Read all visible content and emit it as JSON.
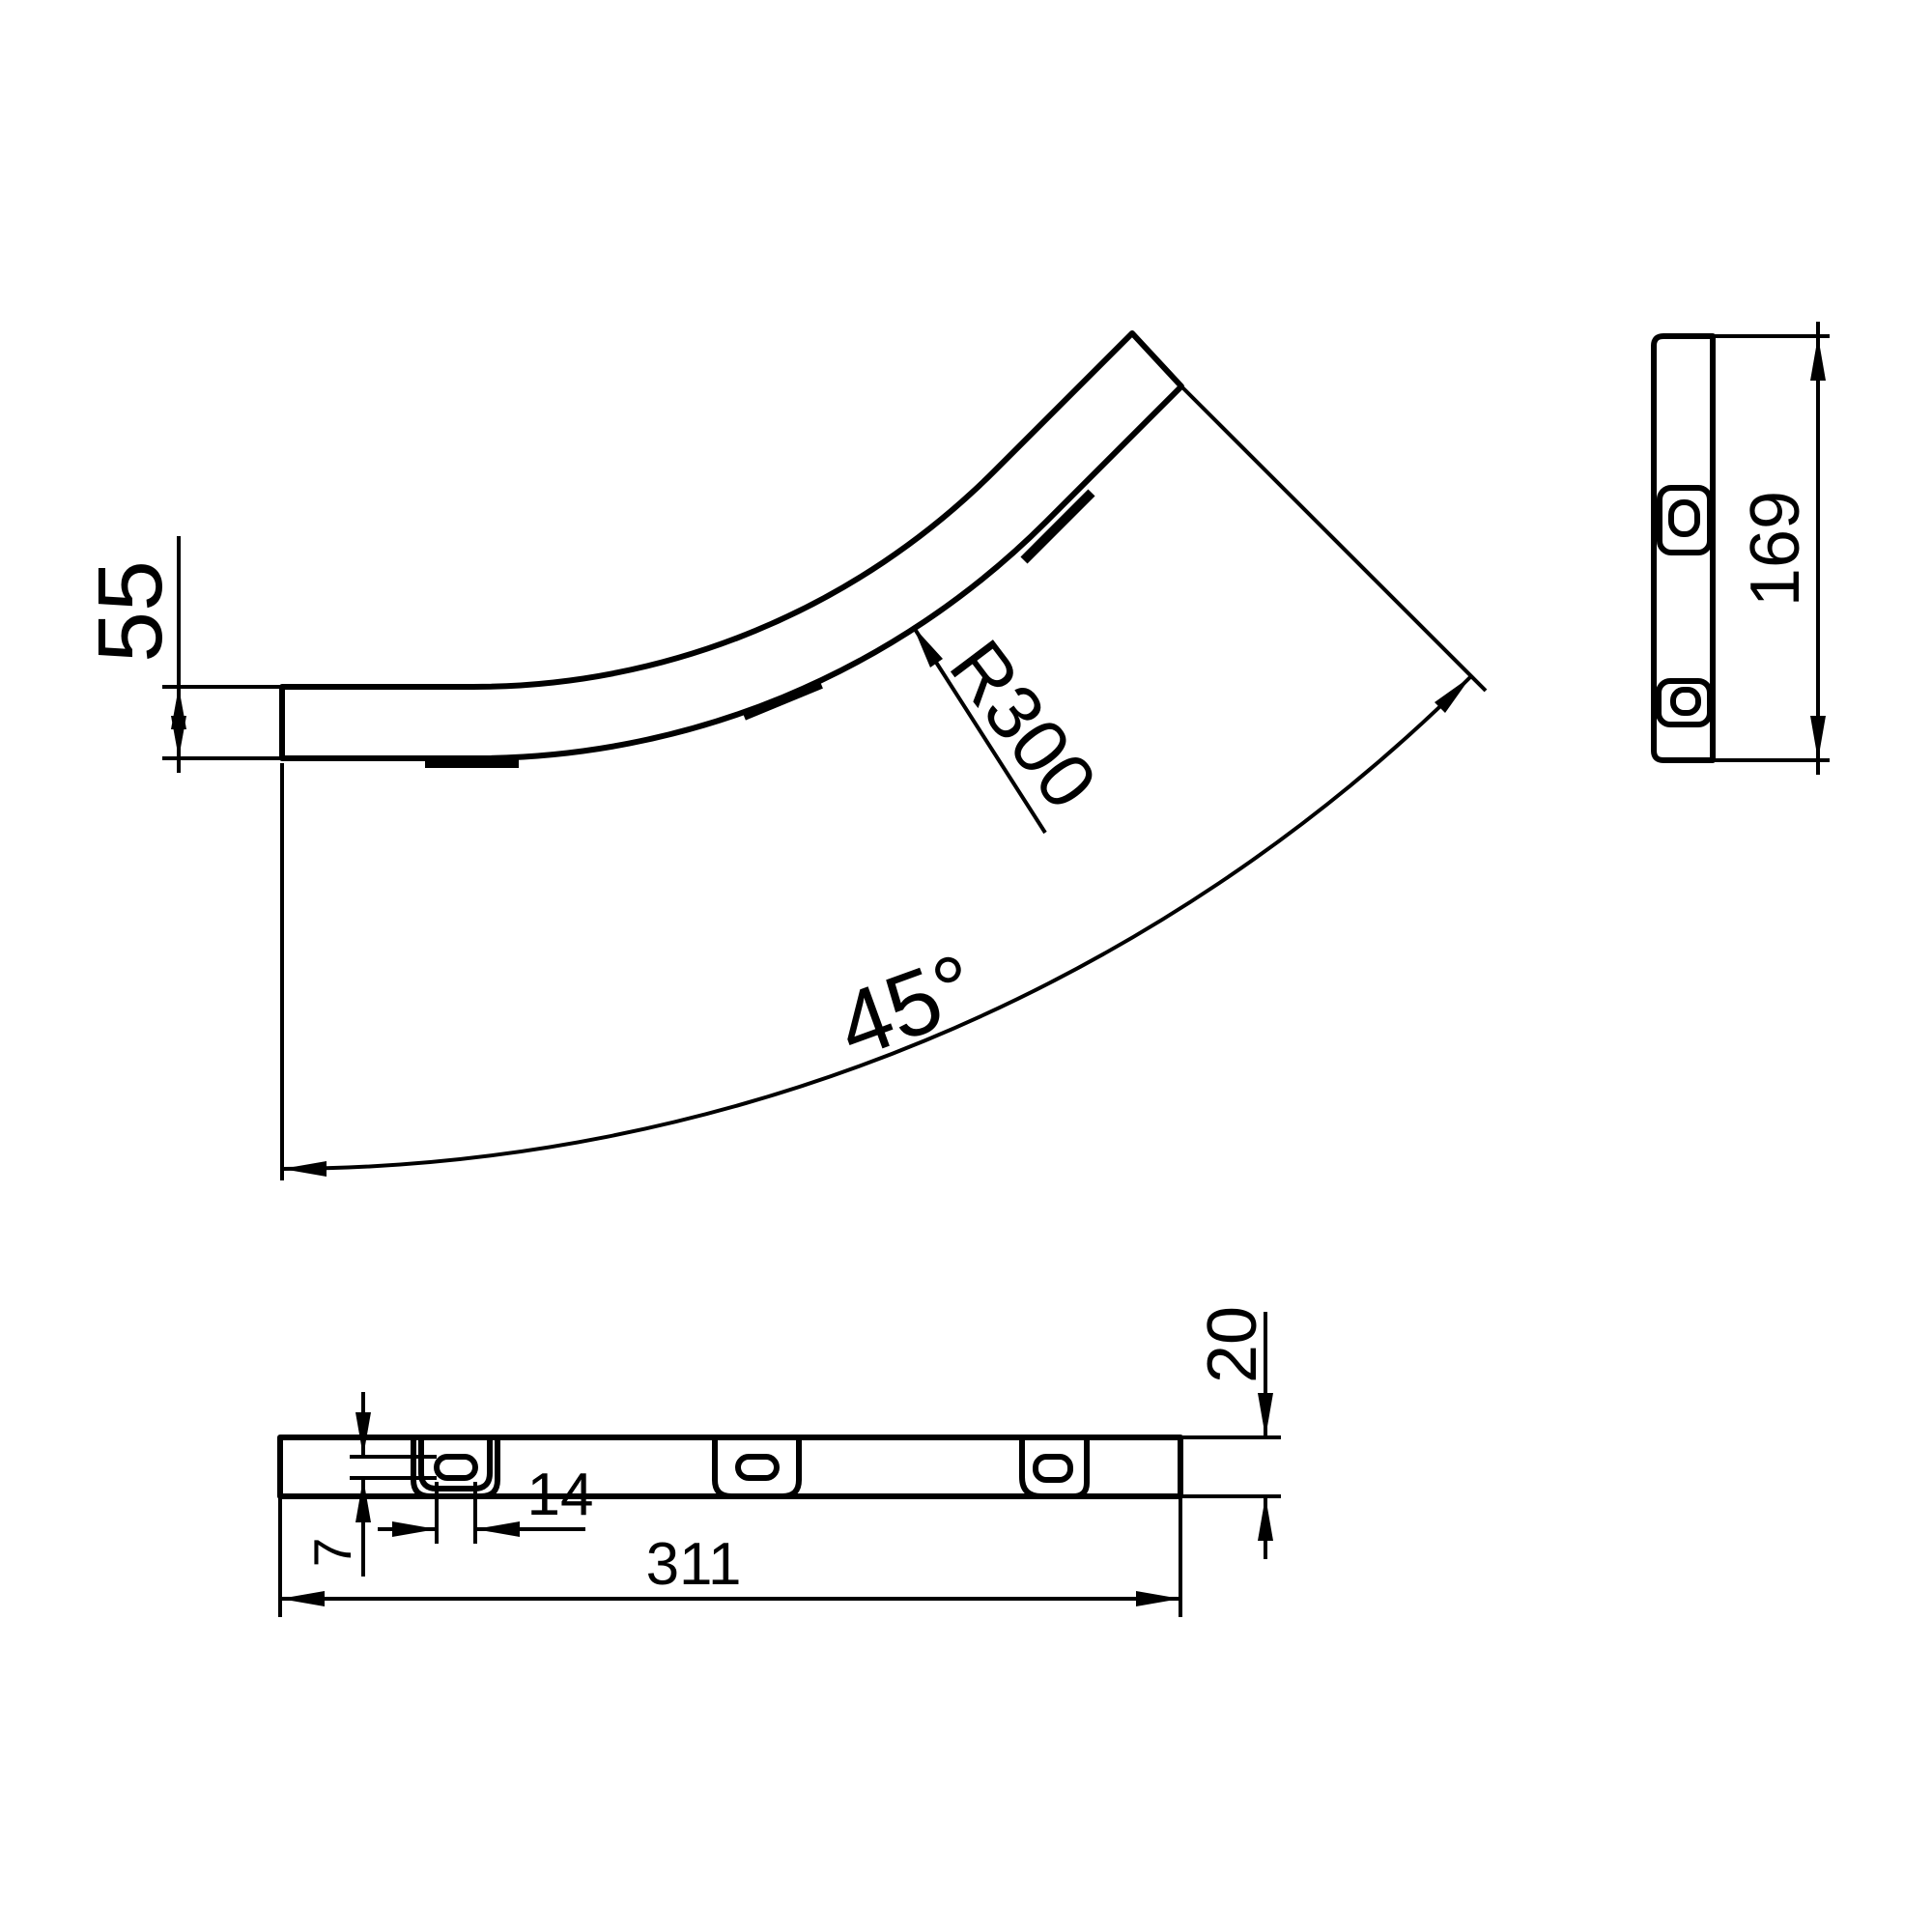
{
  "drawing": {
    "labels": {
      "side_height": "55",
      "bend_radius": "R300",
      "bend_angle": "45°",
      "end_width": "169",
      "overall_length": "311",
      "slot_length": "14",
      "slot_width": "7",
      "flange_height": "20"
    },
    "colors": {
      "line": "#000000",
      "background": "#ffffff"
    }
  }
}
